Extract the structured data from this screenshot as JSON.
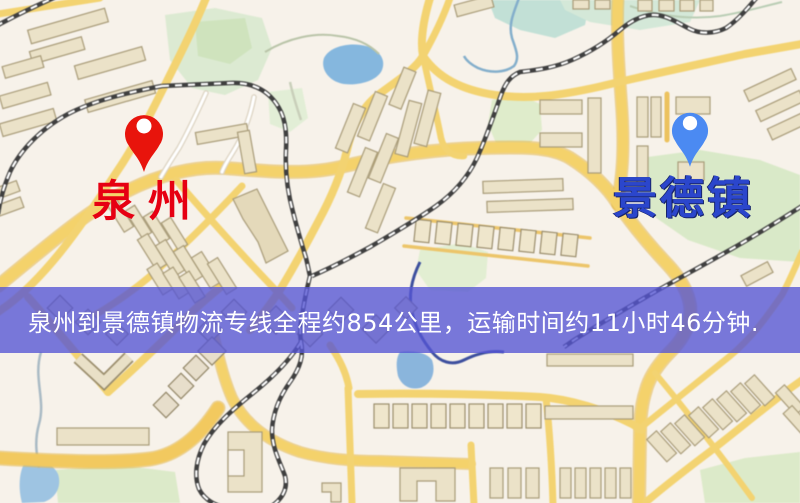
{
  "map": {
    "origin": {
      "label": "泉州",
      "pin_color": "#e8140c",
      "label_color": "#e60012"
    },
    "destination": {
      "label": "景德镇",
      "pin_color": "#4b8af2",
      "label_color": "#2b46cc"
    },
    "banner": {
      "text": "泉州到景德镇物流专线全程约854公里，运输时间约11小时46分钟.",
      "background_color": "#5454d4",
      "text_color": "#ffffff"
    },
    "route_facts": {
      "origin": "泉州",
      "destination": "景德镇",
      "service_type": "物流专线",
      "distance_text": "约854公里",
      "duration_text": "约11小时46分钟"
    },
    "colors": {
      "map_background": "#f7f2ea",
      "road_major": "#f4d26b",
      "road_minor": "#f3d371",
      "railway": "#3f3f3f",
      "water": "#85b7de",
      "park": "#dcead0",
      "building_fill": "#ebe2c8",
      "building_outline": "#a89b78"
    }
  }
}
